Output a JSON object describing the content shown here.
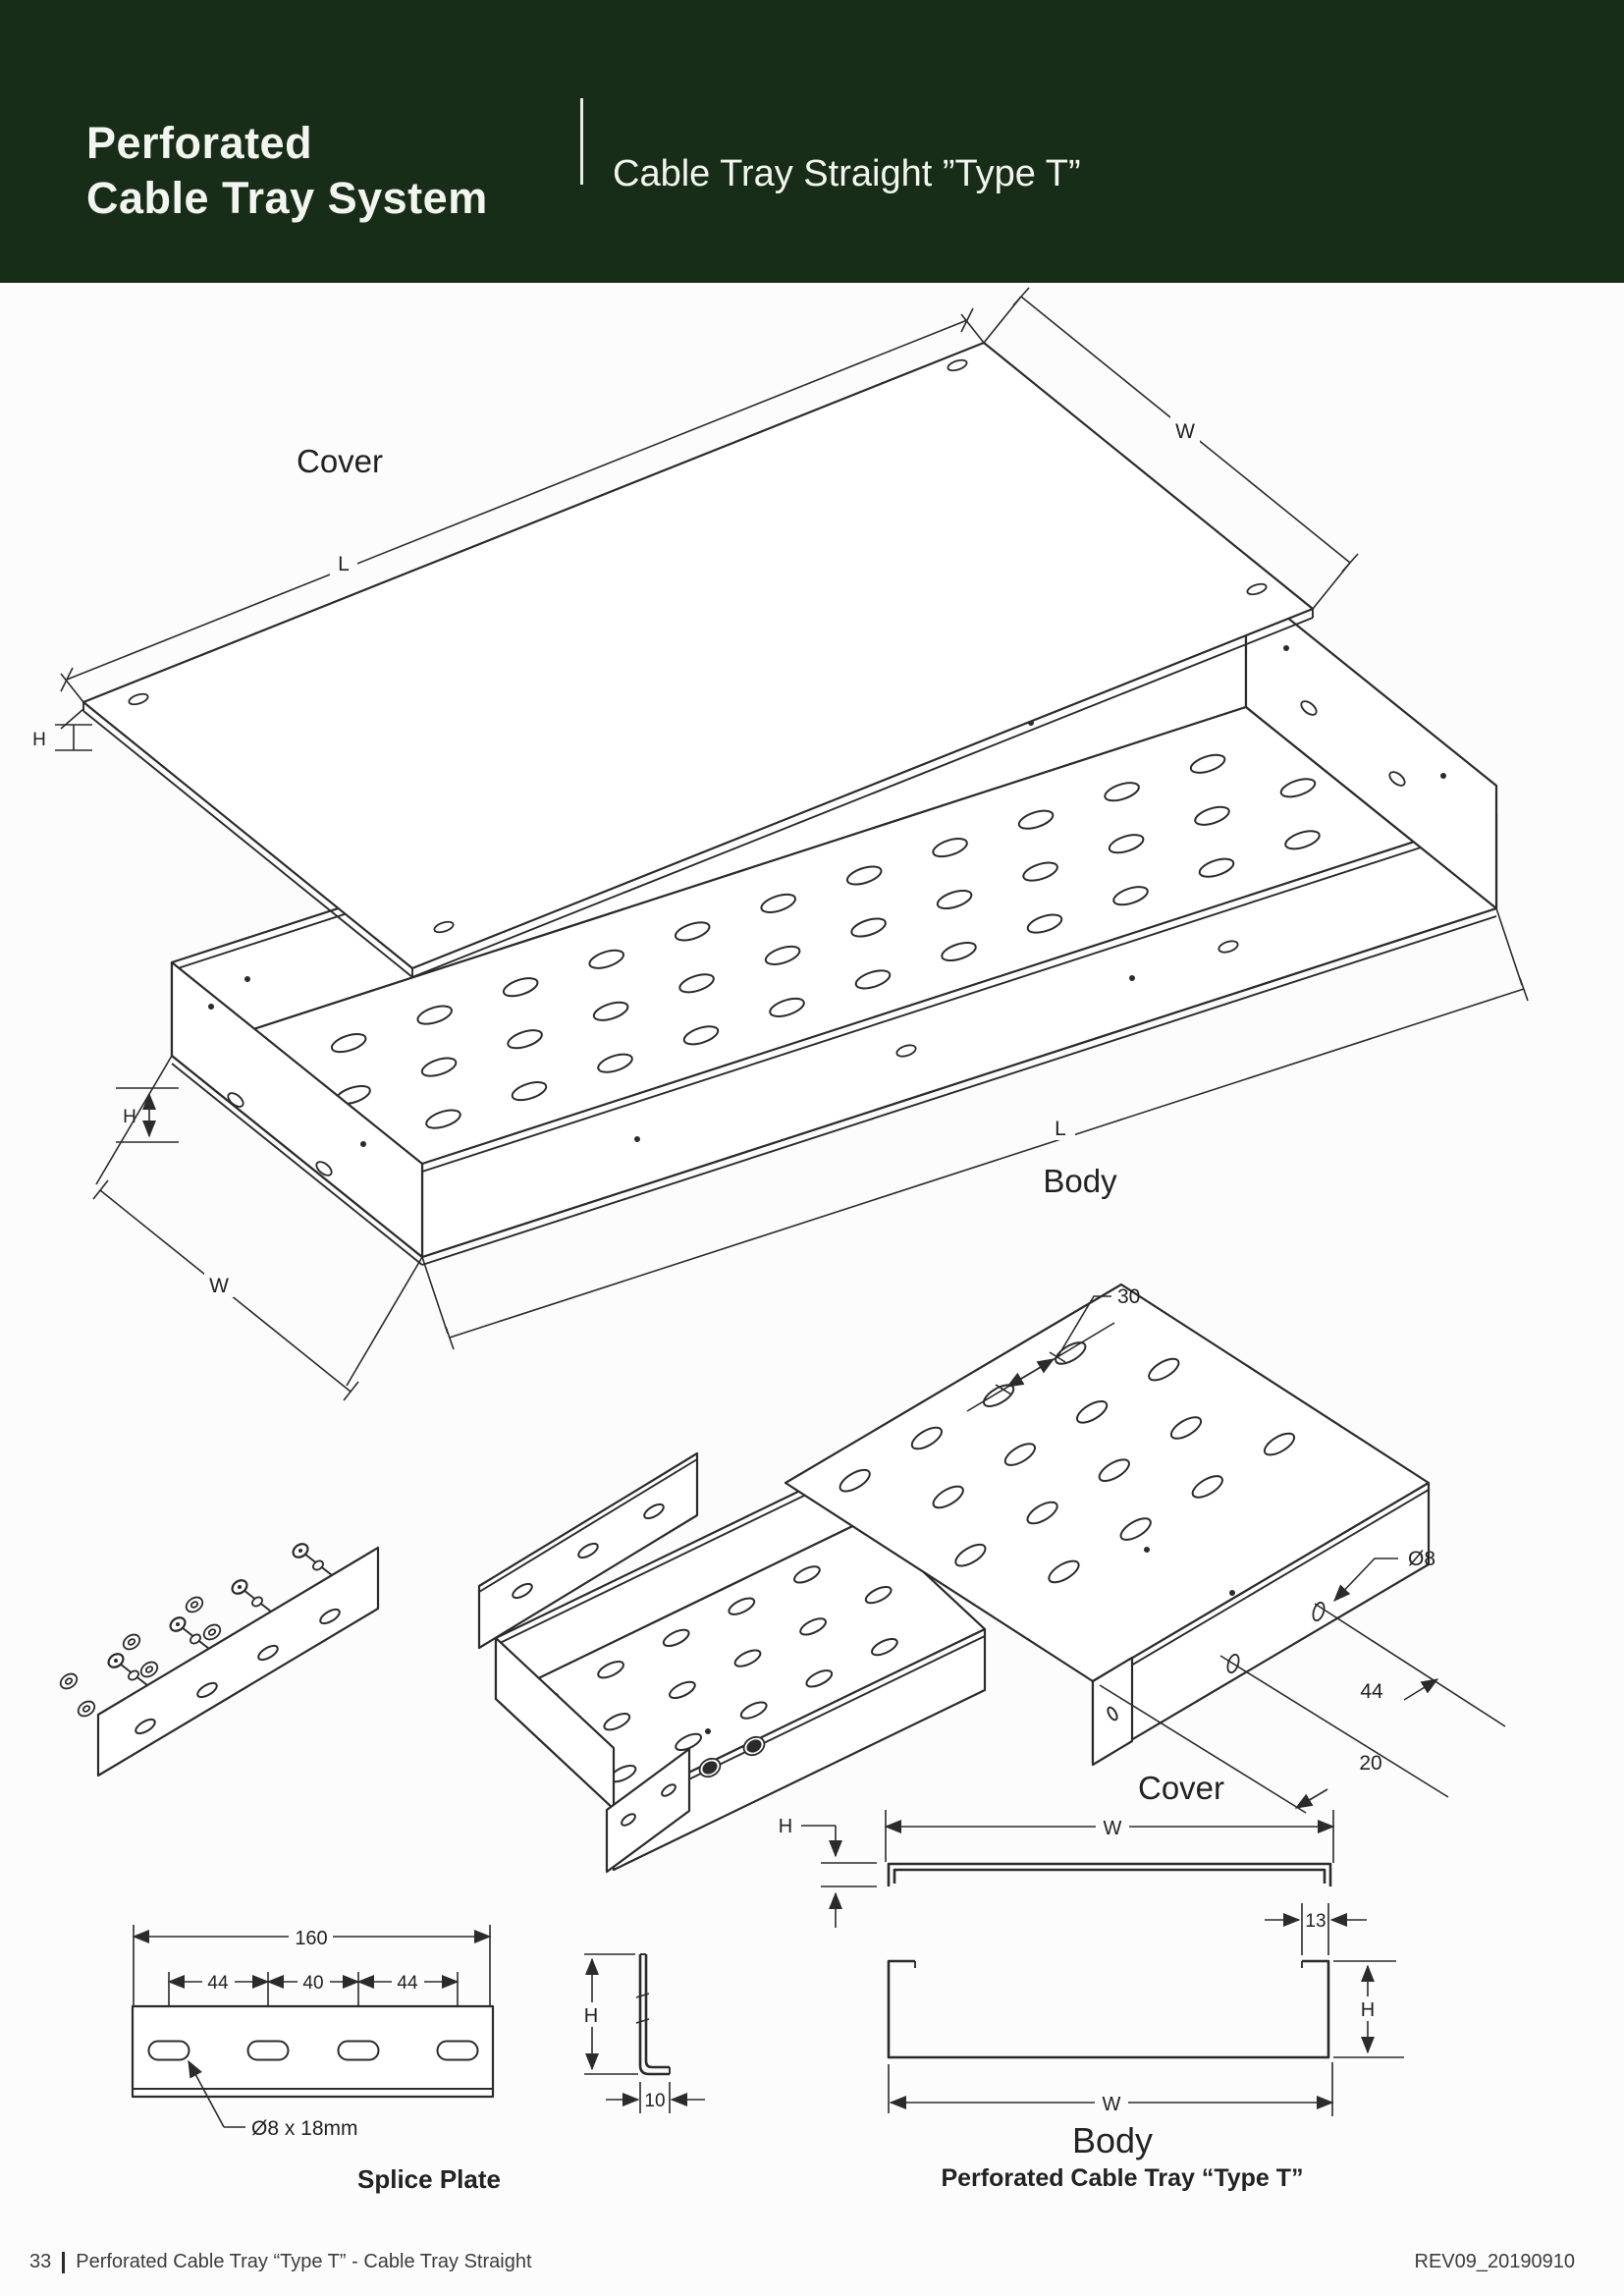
{
  "header": {
    "brand_line1": "Perforated",
    "brand_line2": "Cable Tray System",
    "page_title": "Cable Tray Straight ”Type T”",
    "banner_color": "#182d18",
    "text_color": "#f3f6f0"
  },
  "exploded_view": {
    "cover_label": "Cover",
    "body_label": "Body",
    "cover_dim_length": "L",
    "cover_dim_width": "W",
    "cover_dim_height": "H",
    "body_dim_length": "L",
    "body_dim_width": "W",
    "body_dim_height": "H"
  },
  "cover_detail": {
    "label": "Cover",
    "slot_pitch": "30",
    "hole_diameter": "Ø8",
    "hole_spacing": "44",
    "hole_end_offset": "20"
  },
  "splice_plate": {
    "label": "Splice Plate",
    "overall_length": "160",
    "pitch_left": "44",
    "pitch_middle": "40",
    "pitch_right": "44",
    "hole_note": "Ø8 x 18mm",
    "profile_height": "H",
    "profile_foot": "10"
  },
  "cross_sections": {
    "cover_dim_width": "W",
    "cover_dim_height": "H",
    "body_lip": "13",
    "body_dim_height": "H",
    "body_dim_width": "W",
    "body_label": "Body",
    "caption": "Perforated Cable Tray “Type T”"
  },
  "footer": {
    "page_number": "33",
    "title": "Perforated Cable Tray “Type T” - Cable Tray Straight",
    "revision": "REV09_20190910"
  }
}
